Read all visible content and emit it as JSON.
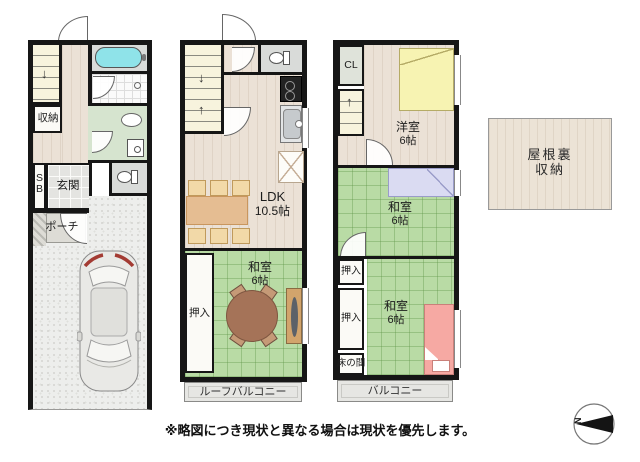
{
  "floor1": {
    "closet": "収納",
    "shoebox": "SB",
    "entrance": "玄関",
    "porch": "ポーチ"
  },
  "floor2": {
    "ldk": "LDK",
    "ldk_size": "10.5帖",
    "japanese_room": "和室",
    "japanese_room_size": "6帖",
    "oshiire": "押入",
    "roof_balcony": "ルーフバルコニー"
  },
  "floor3": {
    "closet": "CL",
    "western_room": "洋室",
    "western_room_size": "6帖",
    "japanese_room_upper": "和室",
    "japanese_room_upper_size": "6帖",
    "oshiire_upper": "押入",
    "oshiire_lower": "押入",
    "tokonoma": "床の間",
    "japanese_room_lower": "和室",
    "japanese_room_lower_size": "6帖",
    "balcony": "バルコニー"
  },
  "attic": {
    "line1": "屋根裏",
    "line2": "収納"
  },
  "footer": {
    "note": "※略図につき現状と異なる場合は現状を優先します。"
  },
  "compass": {
    "north": "N"
  },
  "colors": {
    "wall": "#161616",
    "tatami": "#b9dba5",
    "wood_floor": "#ebe1d6",
    "bathtub": "#8fe3e9",
    "bed_yellow": "#f7f3b2",
    "futon_lavender": "#dadbf2",
    "bed_pink": "#f6a9a3",
    "round_table": "#a57358",
    "dining_table": "#e5bd92"
  }
}
